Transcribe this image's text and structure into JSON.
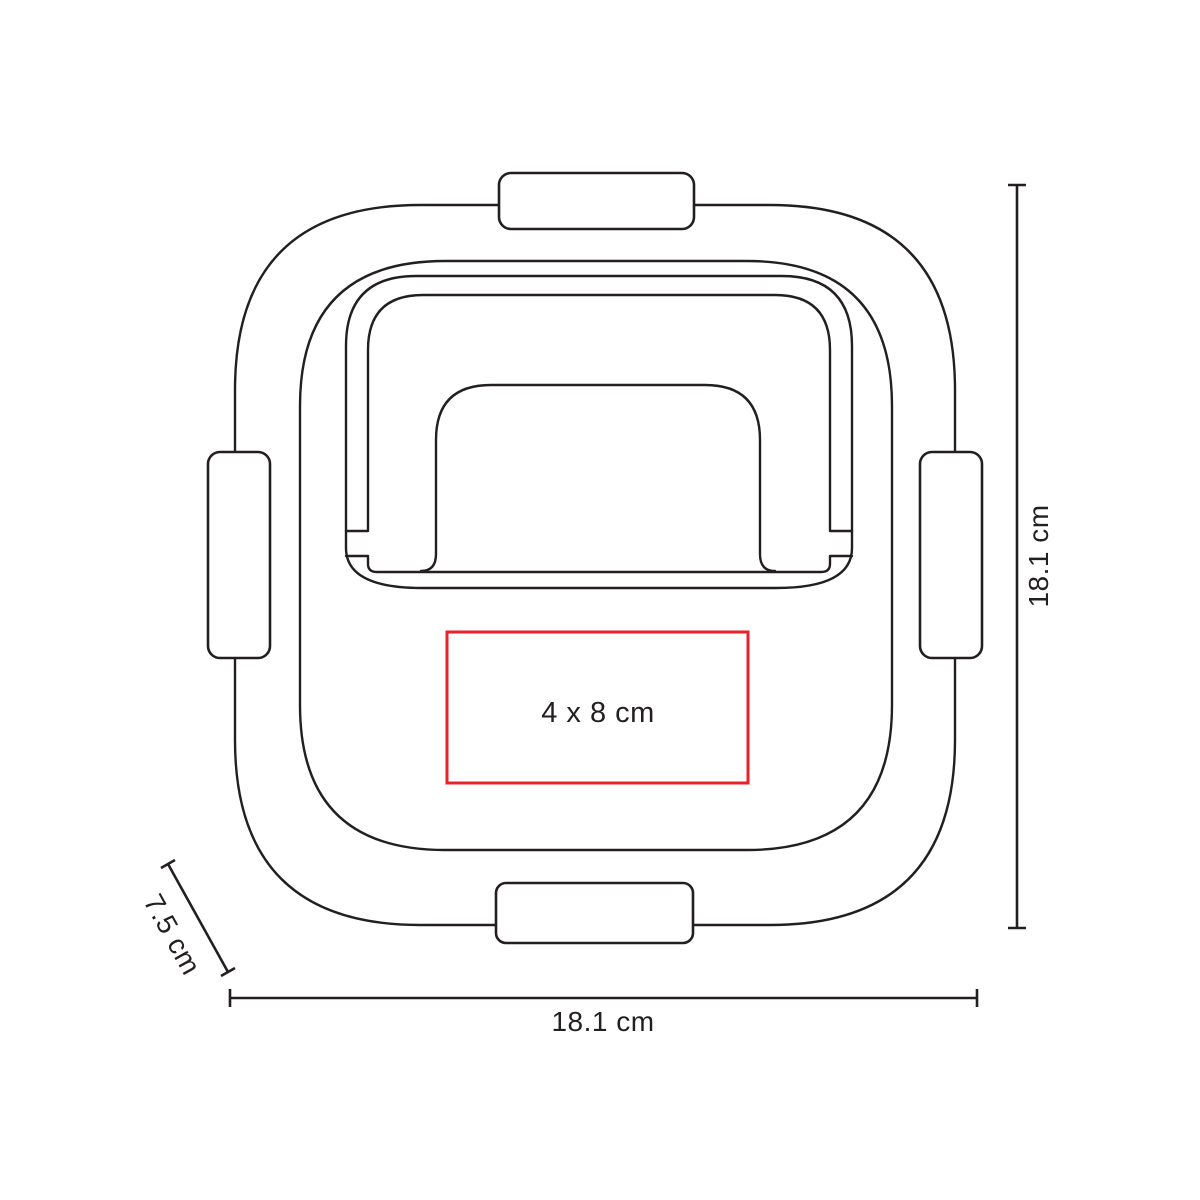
{
  "diagram": {
    "labels": {
      "height_dimension": "18.1 cm",
      "width_dimension": "18.1 cm",
      "depth_dimension": "7.5 cm",
      "print_area": "4 x 8 cm"
    },
    "colors": {
      "outline": "#231f20",
      "print_area_border": "#e8212b",
      "background": "#ffffff"
    }
  }
}
